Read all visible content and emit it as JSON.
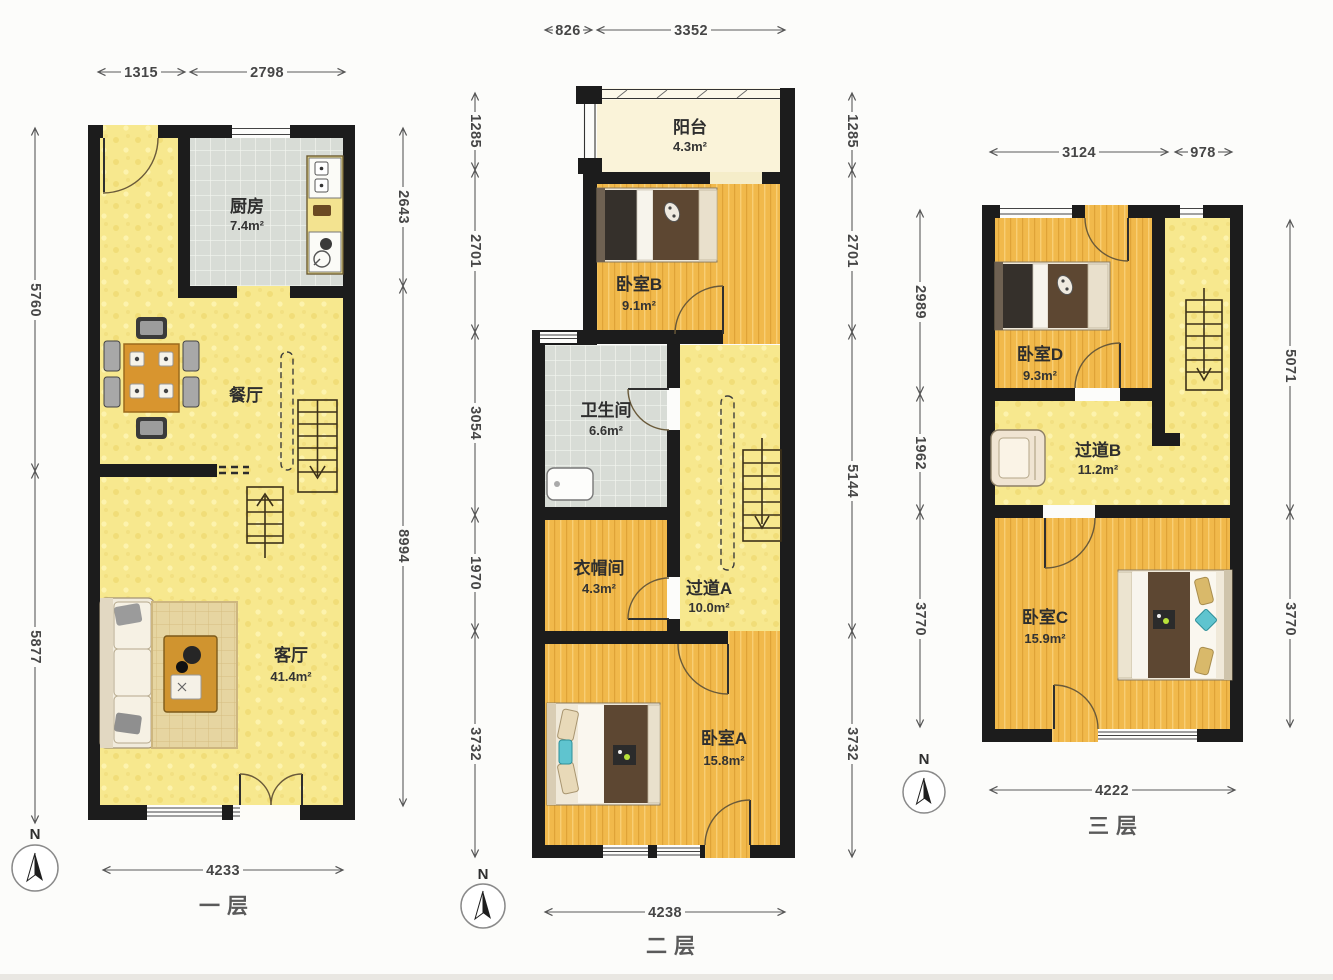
{
  "floors": [
    {
      "name": "first-floor",
      "label": "一层",
      "compass": "N",
      "rooms": [
        {
          "name": "厨房",
          "area": "7.4m²"
        },
        {
          "name": "餐厅",
          "area": ""
        },
        {
          "name": "客厅",
          "area": "41.4m²"
        }
      ],
      "dims": {
        "top": [
          "1315",
          "2798"
        ],
        "left": [
          "5760",
          "5877"
        ],
        "right": [
          "2643",
          "8994"
        ],
        "bottom": [
          "4233"
        ]
      }
    },
    {
      "name": "second-floor",
      "label": "二层",
      "compass": "N",
      "rooms": [
        {
          "name": "阳台",
          "area": "4.3m²"
        },
        {
          "name": "卧室B",
          "area": "9.1m²"
        },
        {
          "name": "卫生间",
          "area": "6.6m²"
        },
        {
          "name": "衣帽间",
          "area": "4.3m²"
        },
        {
          "name": "过道A",
          "area": "10.0m²"
        },
        {
          "name": "卧室A",
          "area": "15.8m²"
        }
      ],
      "dims": {
        "top": [
          "826",
          "3352"
        ],
        "left": [
          "1285",
          "2701",
          "3054",
          "1970",
          "3732"
        ],
        "right": [
          "1285",
          "2701",
          "5144",
          "3732"
        ],
        "bottom": [
          "4238"
        ]
      }
    },
    {
      "name": "third-floor",
      "label": "三层",
      "compass": "N",
      "rooms": [
        {
          "name": "卧室D",
          "area": "9.3m²"
        },
        {
          "name": "过道B",
          "area": "11.2m²"
        },
        {
          "name": "卧室C",
          "area": "15.9m²"
        }
      ],
      "dims": {
        "top": [
          "3124",
          "978"
        ],
        "left": [
          "2989",
          "1962",
          "3770"
        ],
        "right": [
          "5071",
          "3770"
        ],
        "bottom": [
          "4222"
        ]
      }
    }
  ],
  "colors": {
    "wall": "#1c1c1c",
    "wood_floor": "#f1b94b",
    "pale_floor": "#f7e88e",
    "tile_floor": "#d8dcd6",
    "balcony_floor": "#faf3d9"
  }
}
